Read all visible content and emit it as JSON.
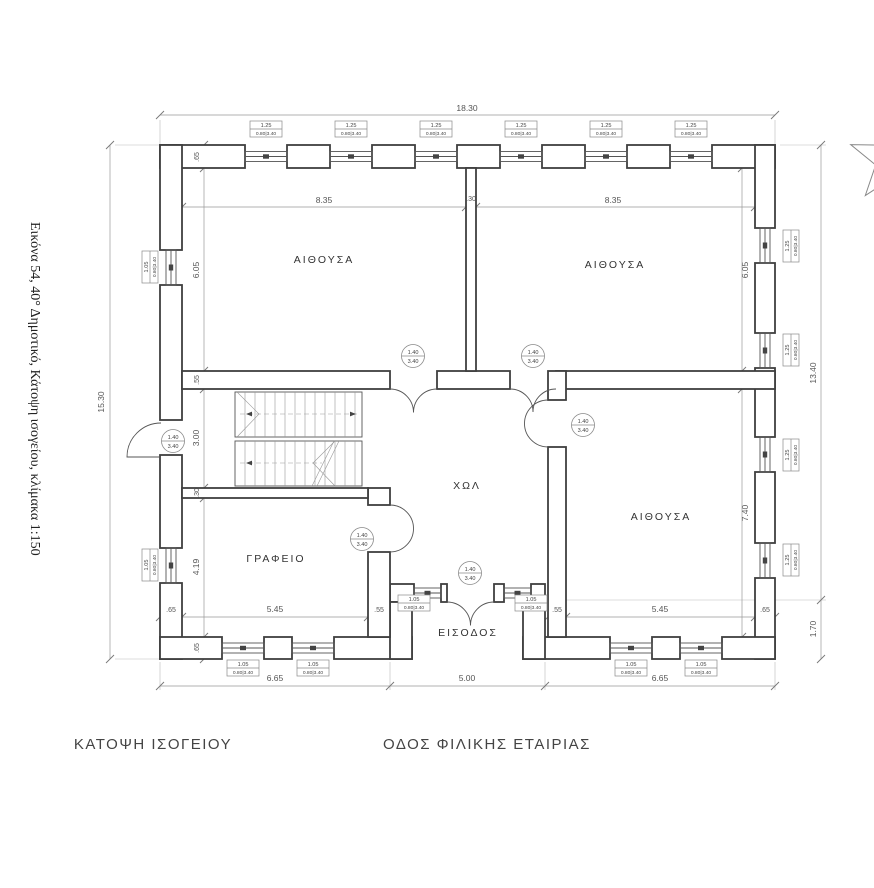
{
  "caption": {
    "side_text": "Εικόνα 54, 40° Δημοτικό, Κάτοψη ισογείου, κλίμακα 1:150"
  },
  "titles": {
    "plan": "ΚΑΤΟΨΗ ΙΣΟΓΕΙΟΥ",
    "street": "ΟΔΟΣ ΦΙΛΙΚΗΣ ΕΤΑΙΡΙΑΣ"
  },
  "rooms": {
    "classroom": "ΑΙΘΟΥΣΑ",
    "office": "ΓΡΑΦΕΙΟ",
    "hall": "ΧΩΛ",
    "entrance": "ΕΙΣΟΔΟΣ"
  },
  "dimensions": {
    "overall_width": "18.30",
    "overall_left": "15.30",
    "overall_right": "13.40",
    "porch_depth": "1.70",
    "classroom_w": "8.35",
    "partition": ".30",
    "classroom_h": "6.05",
    "wall_exterior": ".65",
    "wall_interior": ".55",
    "hall_h": "3.00",
    "wall_thin": ".30",
    "office_h": "4.19",
    "office_w": "5.45",
    "classroom_br_h": "7.40",
    "classroom_br_w": "5.45",
    "front_left": "6.65",
    "front_center": "5.00",
    "front_right": "6.65"
  },
  "tags": {
    "window_wide": {
      "top": "1.25",
      "bottom": "0.80|3.40"
    },
    "window_narrow": {
      "top": "1.05",
      "bottom": "0.80|3.40"
    },
    "door": {
      "top": "1.40",
      "bottom": "3.40"
    }
  },
  "colors": {
    "wall_line": "#3f3f3f",
    "dim_line": "#999999",
    "text": "#3a3a3a",
    "background": "#ffffff"
  }
}
